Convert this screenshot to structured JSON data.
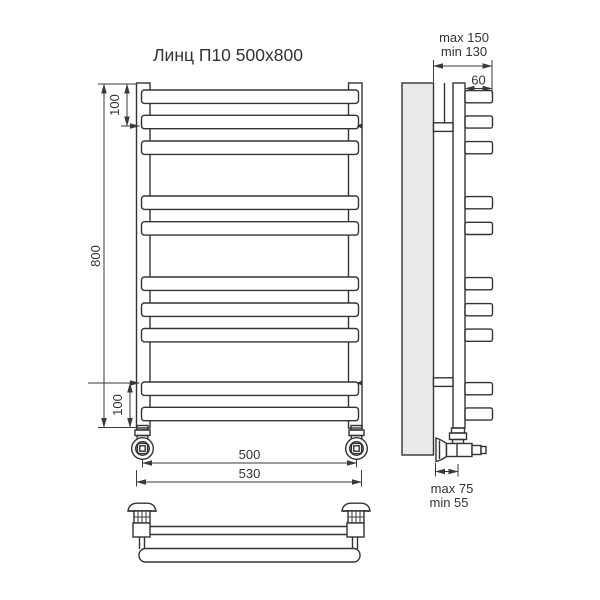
{
  "title": "Линц П10 500x800",
  "front_view": {
    "dim_top_offset": "100",
    "dim_height": "800",
    "dim_bottom_offset": "100",
    "dim_pipe_centers": "500",
    "dim_overall_width": "530"
  },
  "side_view": {
    "dim_wall_distance_max": "max 150",
    "dim_wall_distance_min": "min 130",
    "dim_rung_depth": "60",
    "dim_valve_offset_max": "max 75",
    "dim_valve_offset_min": "min 55"
  },
  "colors": {
    "line": "#333333",
    "wall_fill": "#e9e9e9",
    "background": "#ffffff"
  }
}
